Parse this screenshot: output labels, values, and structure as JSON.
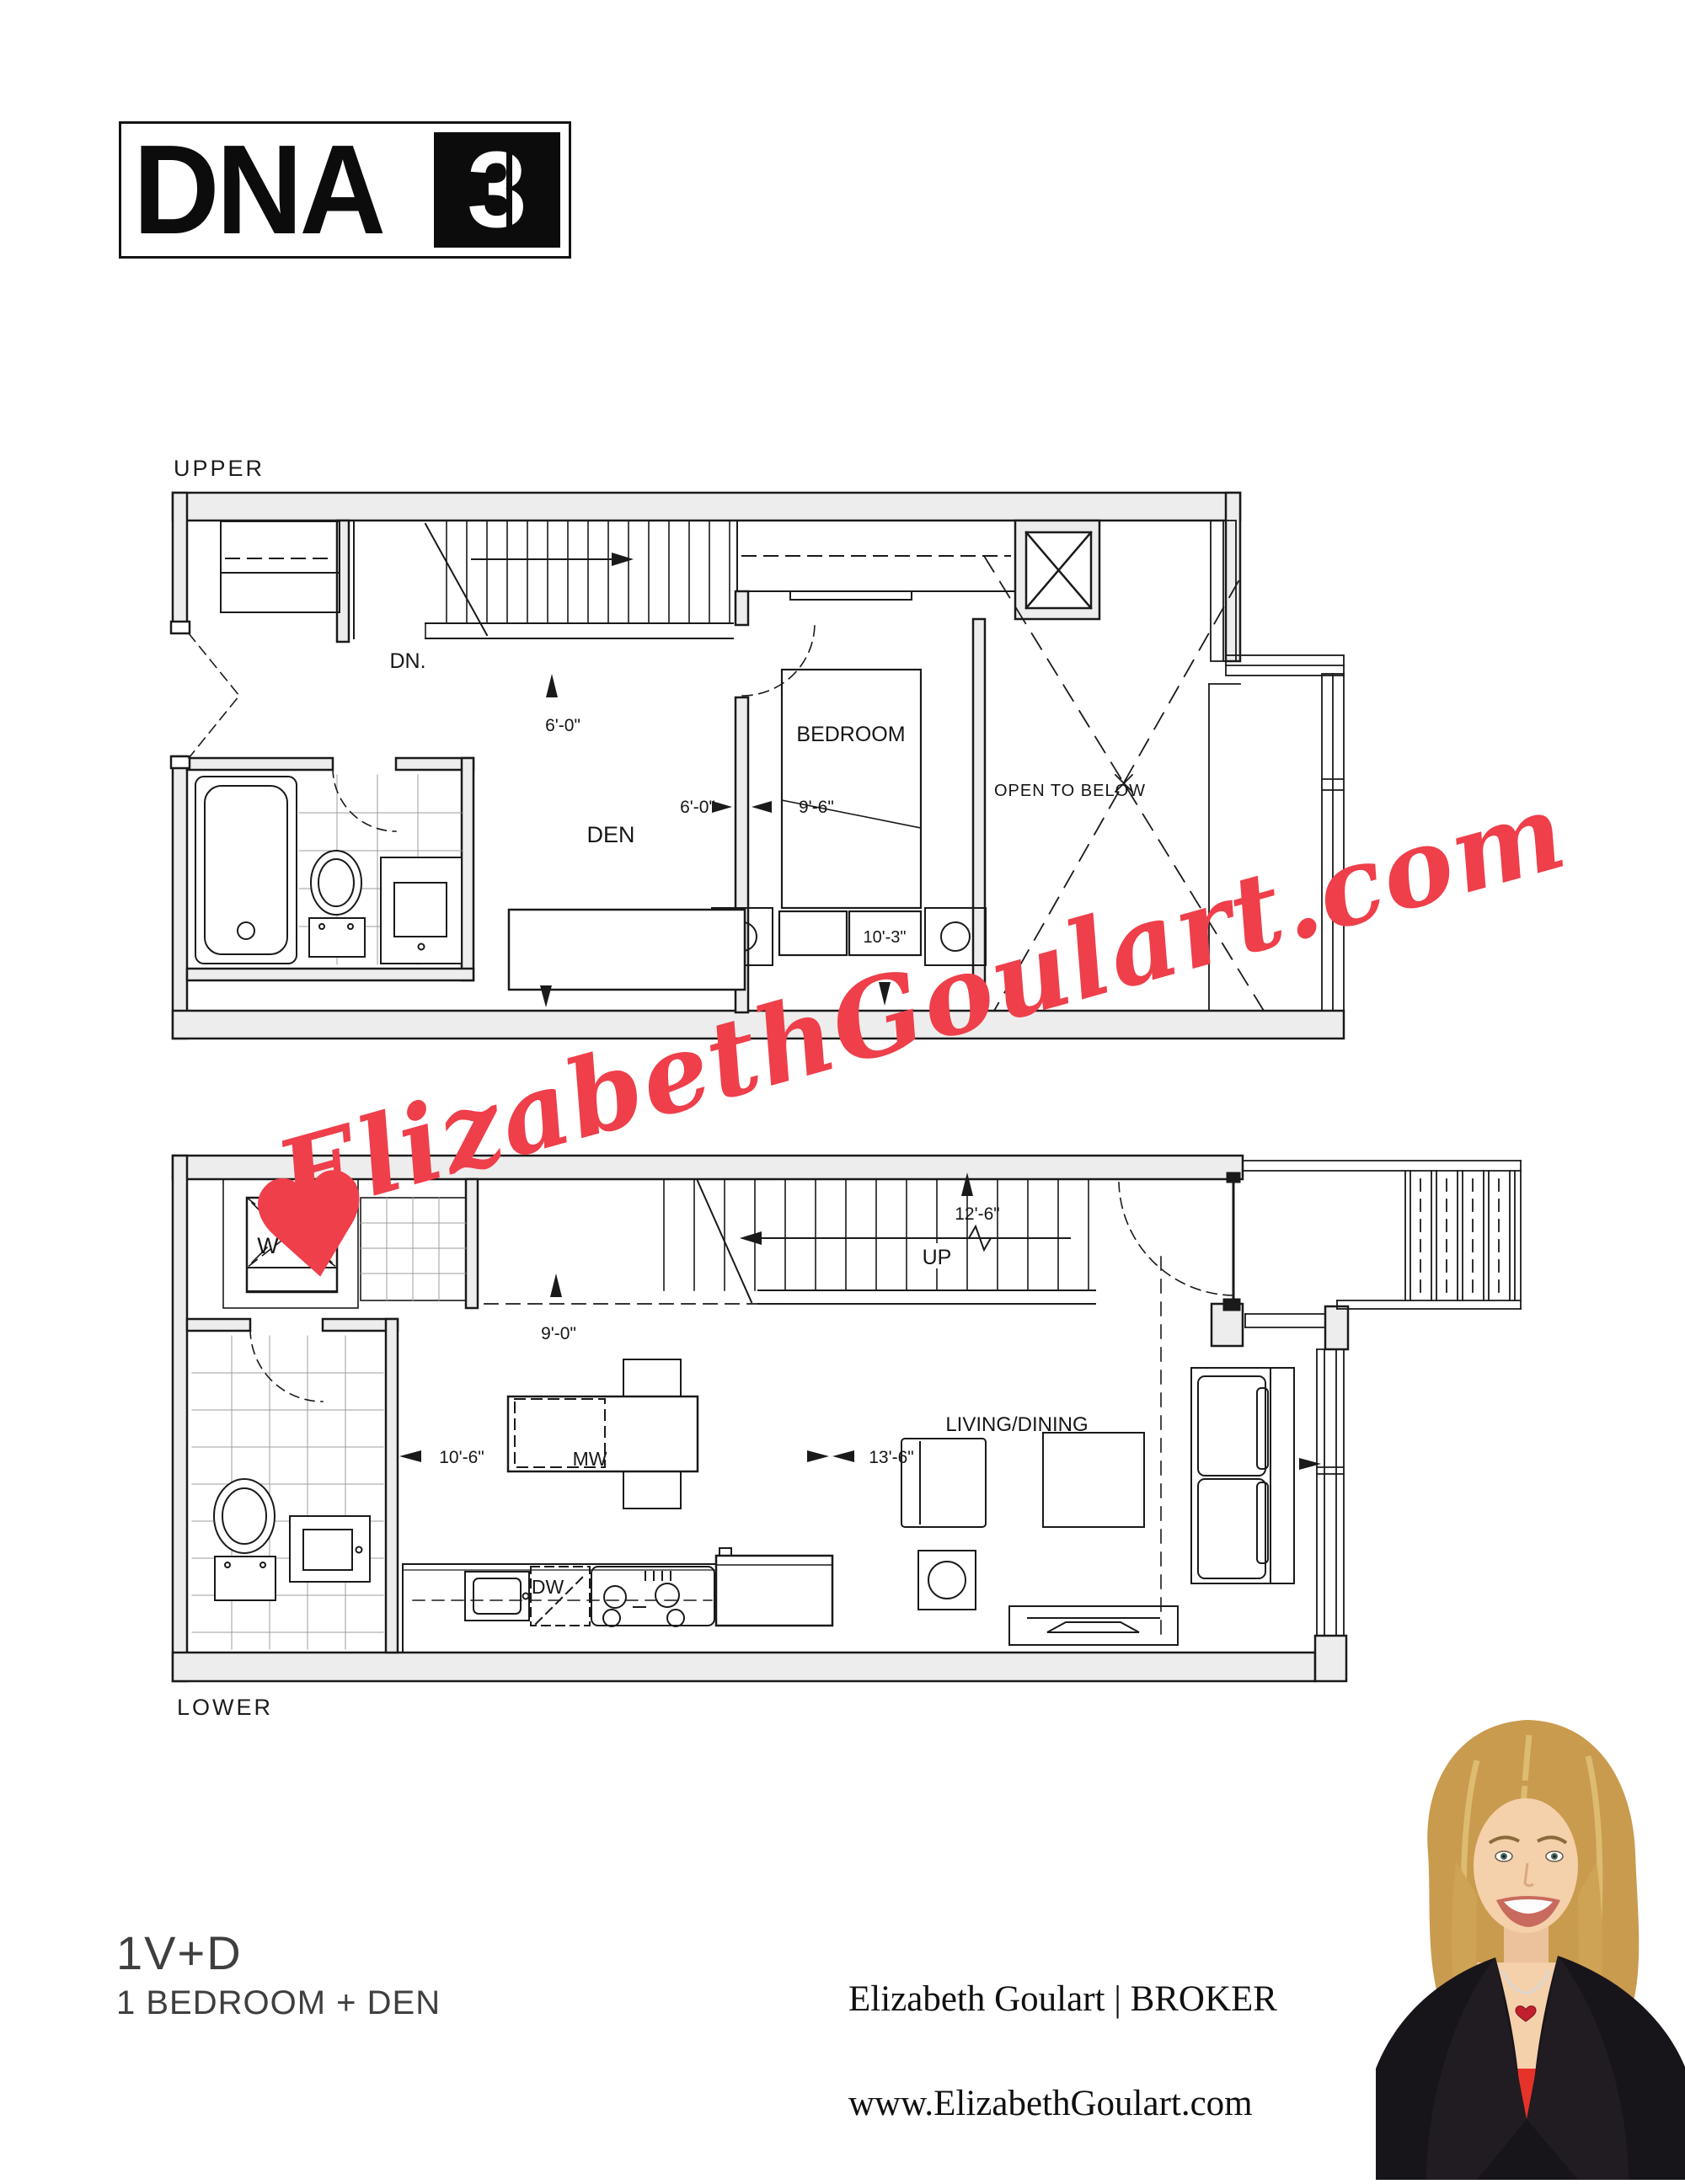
{
  "logo": {
    "dna": "DNA",
    "three": "3"
  },
  "upper_plan": {
    "label": "UPPER",
    "stair_direction": "DN.",
    "room_den": "DEN",
    "room_bedroom": "BEDROOM",
    "room_open_to_below": "OPEN TO BELOW",
    "dim_den_depth": "6'-0\"",
    "dim_den_width": "6'-0\"",
    "dim_bedroom_width": "9'-6\"",
    "dim_bedroom_length": "10'-3\""
  },
  "lower_plan": {
    "label": "LOWER",
    "stair_direction": "UP",
    "room_living_dining": "LIVING/DINING",
    "washer": "W",
    "dryer": "D",
    "microwave": "MW",
    "dishwasher": "DW",
    "dim_entry": "9'-0\"",
    "dim_kitchen": "10'-6\"",
    "dim_living_width": "13'-6\"",
    "dim_living_length": "12'-6\""
  },
  "watermark": {
    "text": "ElizabethGoulart.com",
    "heart": "♥",
    "color": "#ee3f4a"
  },
  "footer": {
    "unit_code": "1V+D",
    "unit_description": "1 BEDROOM + DEN",
    "agent": "Elizabeth Goulart | BROKER",
    "website": "www.ElizabethGoulart.com"
  }
}
